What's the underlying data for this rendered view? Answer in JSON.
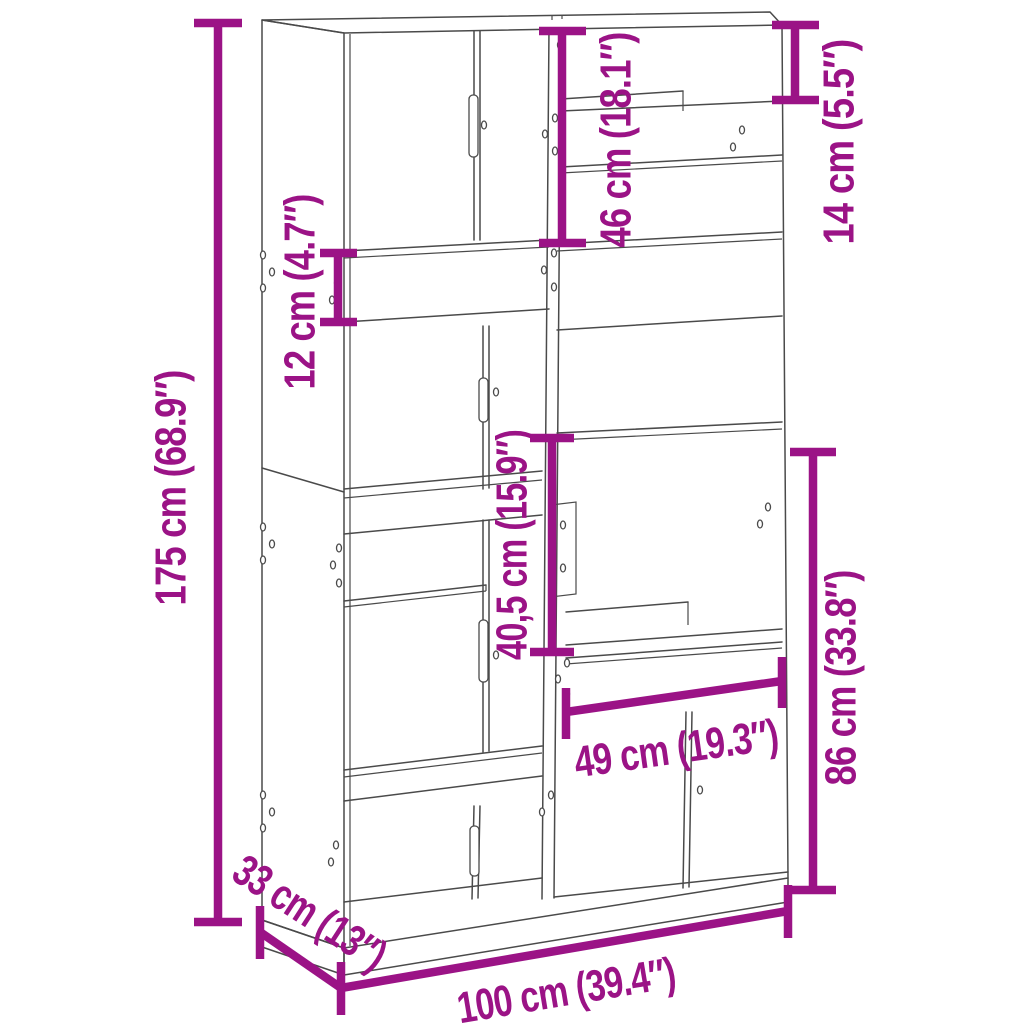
{
  "diagram": {
    "type": "furniture-dimension-diagram",
    "product": "bookcase-room-divider",
    "background_color": "#FFFFFF",
    "artwork_line_color": "#4A4A4A",
    "accent_color": "#9B1386",
    "units": [
      "cm",
      "inches"
    ],
    "dimensions": {
      "total_height": {
        "label": "175 cm (68.9″)",
        "cm": "175",
        "inches": "68.9",
        "axis": "vertical"
      },
      "shelf_gap_12": {
        "label": "12 cm (4.7″)",
        "cm": "12",
        "inches": "4.7",
        "axis": "vertical"
      },
      "top_section_46": {
        "label": "46 cm (18.1″)",
        "cm": "46",
        "inches": "18.1",
        "axis": "vertical"
      },
      "top_gap_14": {
        "label": "14 cm (5.5″)",
        "cm": "14",
        "inches": "5.5",
        "axis": "vertical"
      },
      "mid_section_40_5": {
        "label": "40,5 cm (15.9″)",
        "cm": "40,5",
        "inches": "15.9",
        "axis": "vertical"
      },
      "right_opening_86": {
        "label": "86 cm (33.8″)",
        "cm": "86",
        "inches": "33.8",
        "axis": "vertical"
      },
      "opening_width_49": {
        "label": "49 cm (19.3″)",
        "cm": "49",
        "inches": "19.3",
        "axis": "horizontal"
      },
      "depth_33": {
        "label": "33 cm (13″)",
        "cm": "33",
        "inches": "13",
        "axis": "depth"
      },
      "total_width_100": {
        "label": "100 cm (39.4″)",
        "cm": "100",
        "inches": "39.4",
        "axis": "horizontal"
      }
    }
  }
}
